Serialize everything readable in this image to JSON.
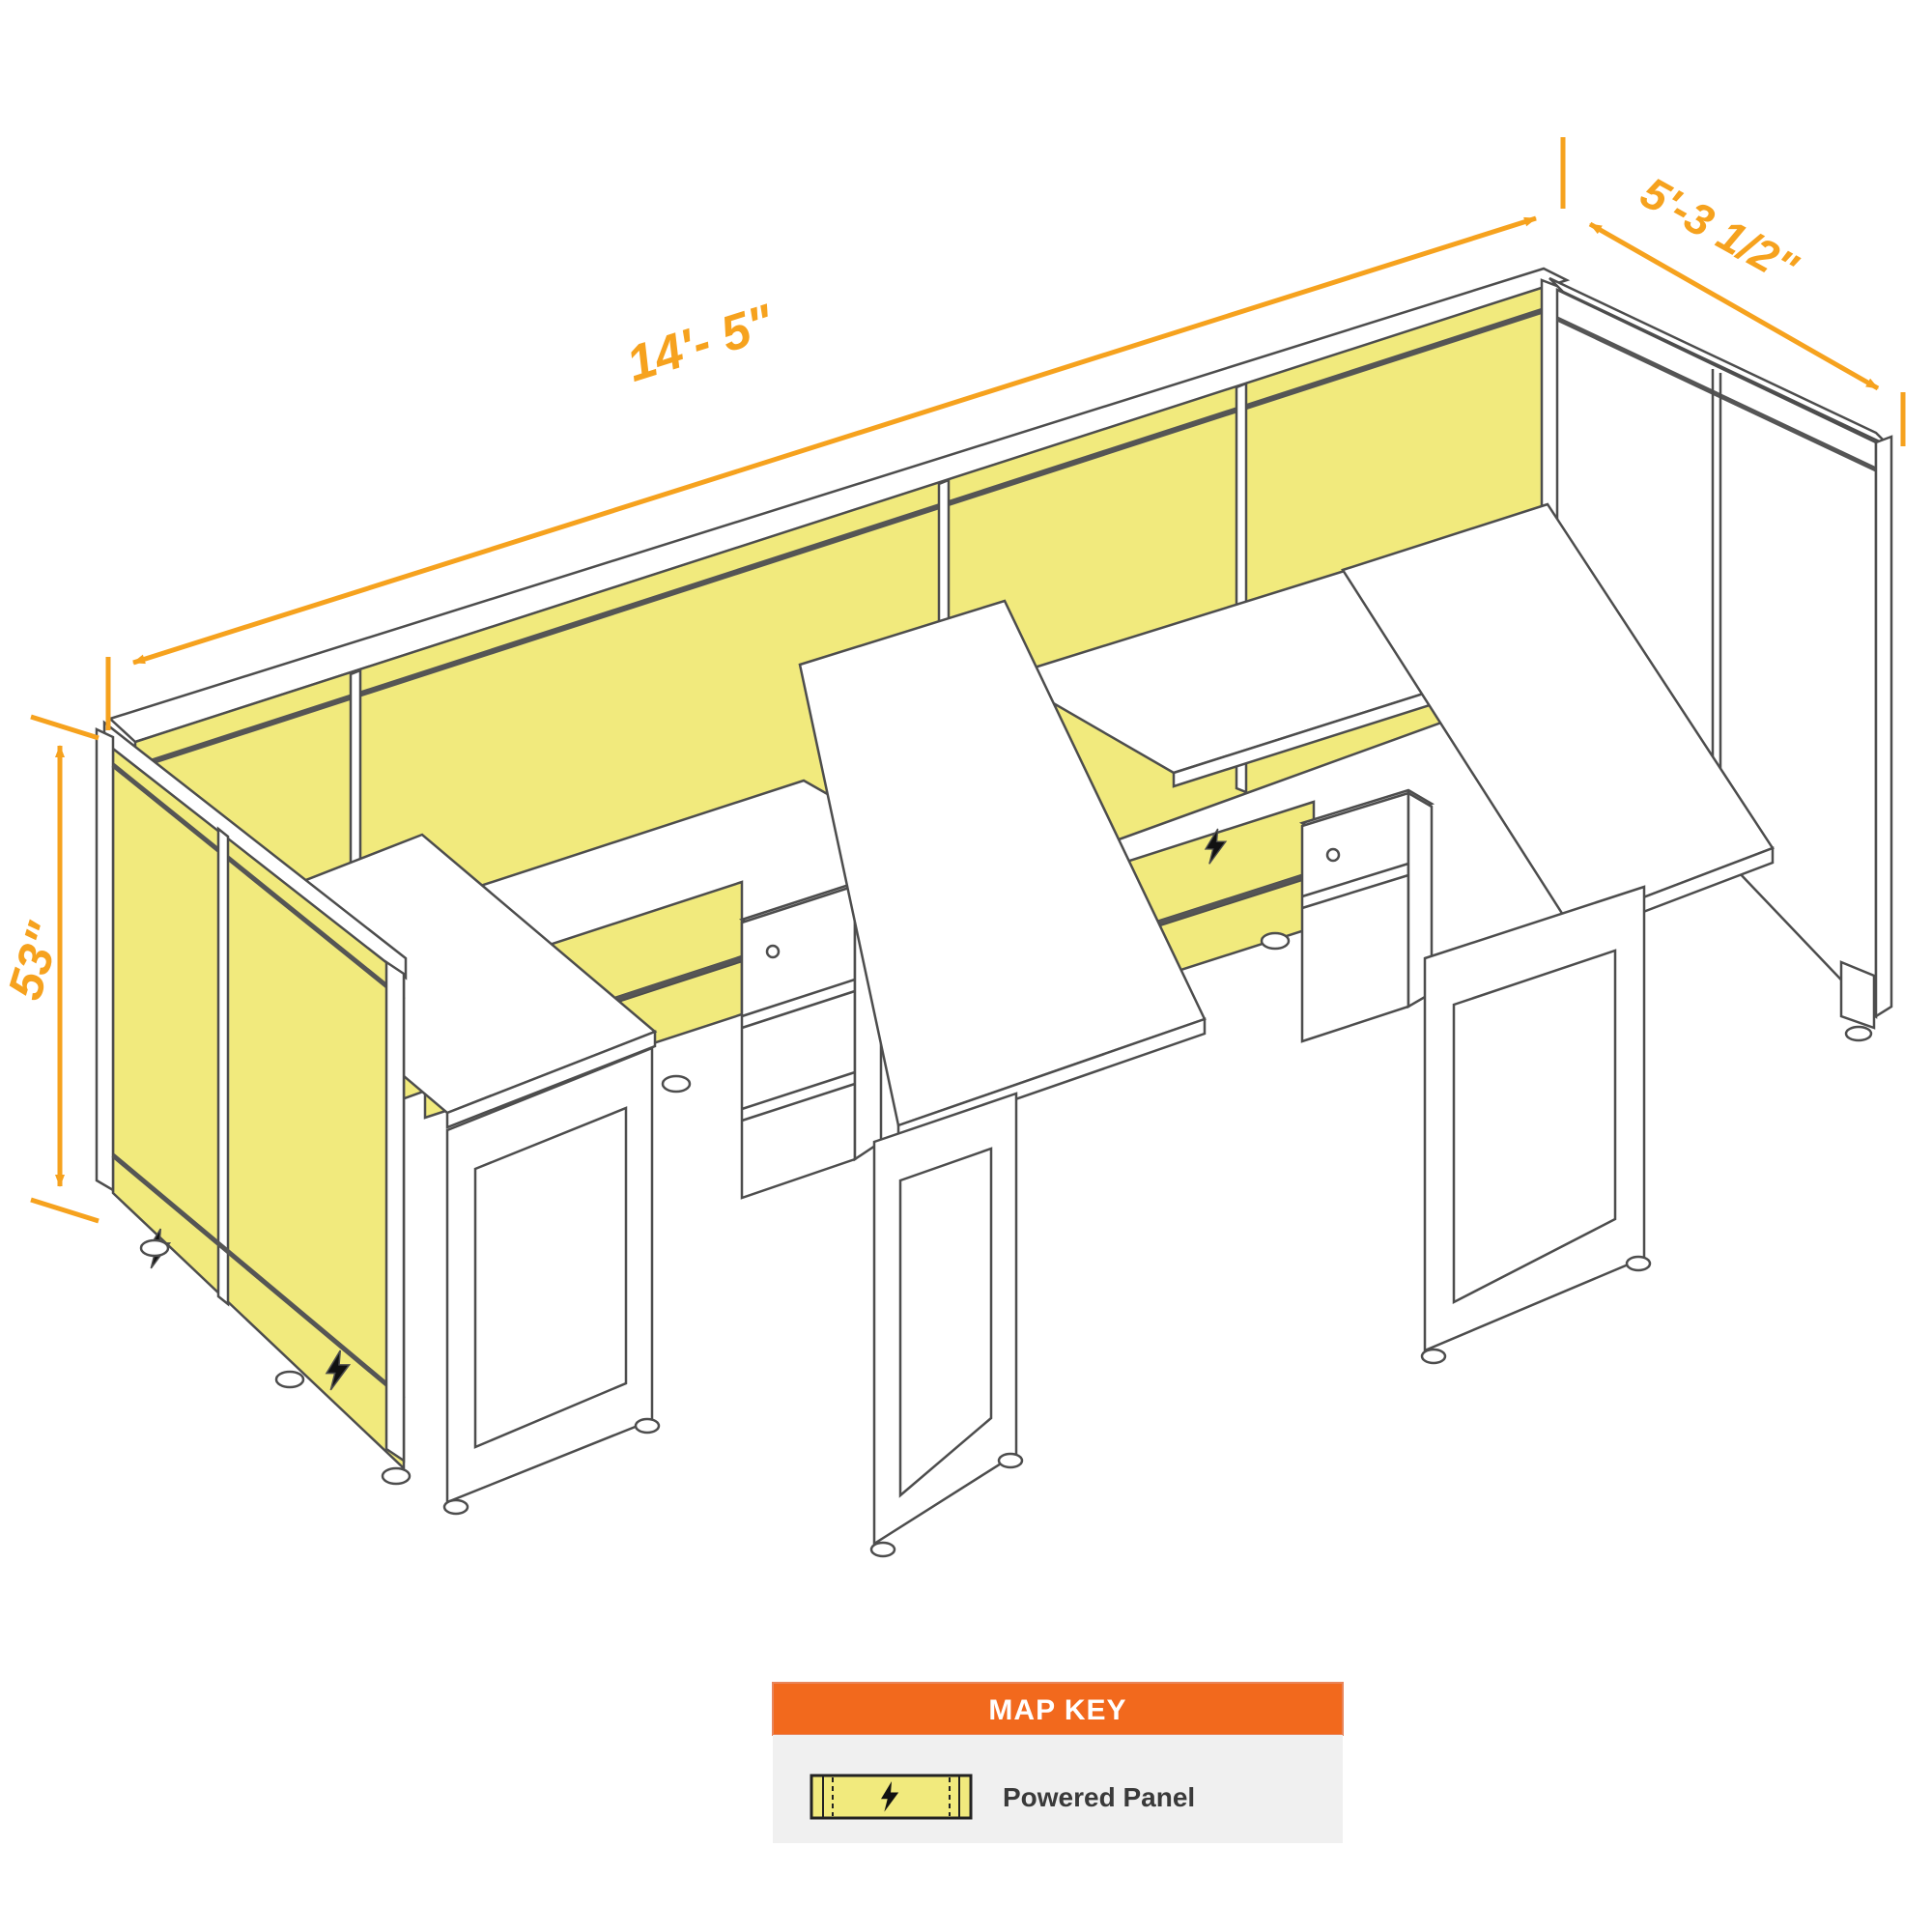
{
  "diagram": {
    "title": "Two-station powered cubicle workstation isometric drawing",
    "dimensions": {
      "width": "14'- 5\"",
      "depth": "5'-3 1/2\"",
      "height": "53\""
    },
    "legend": {
      "title": "MAP KEY",
      "items": [
        {
          "label": "Powered Panel",
          "icon": "lightning-bolt-icon"
        }
      ]
    },
    "icons": {
      "powered": "lightning-bolt-icon"
    },
    "colors": {
      "panel_yellow": "#F1EA7D",
      "outline_gray": "#4d4d4d",
      "dimension_orange": "#F6A21E",
      "key_header_orange": "#F2691D",
      "key_body_gray": "#F0F0F0",
      "bolt_black": "#111111"
    }
  }
}
